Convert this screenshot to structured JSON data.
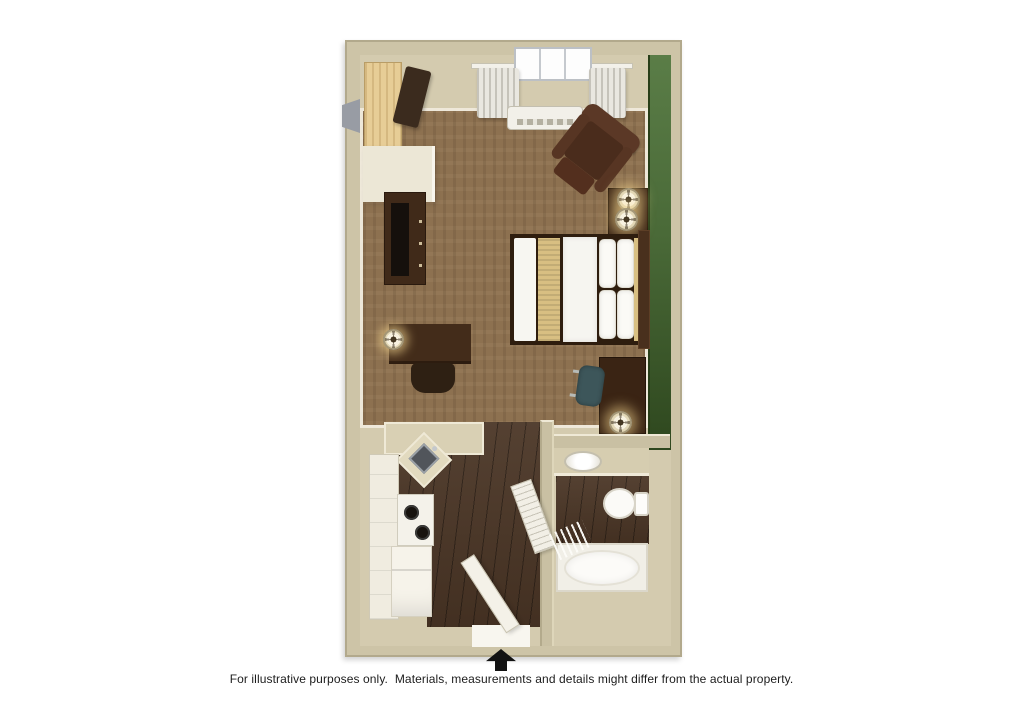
{
  "page": {
    "background_color": "#ffffff"
  },
  "floor_plan": {
    "kind": "studio-suite-3d-floor-plan",
    "colors": {
      "outer_wall": "#cdc4a7",
      "accent_wall_green": "#3f5c2e",
      "carpet_brown": "#8d7150",
      "dark_wood_floor": "#4a3525",
      "dark_furniture": "#3f2a1c",
      "closet_light_wood": "#e7cd96",
      "fixture_white": "#f4f2ec",
      "office_chair_teal": "#3d565a"
    },
    "rooms": {
      "main_room": {
        "floor": "carpet",
        "items": [
          "closet",
          "wardrobe-shelf",
          "tv-dresser",
          "television",
          "desk-with-lamp",
          "desk-chair",
          "window-with-curtains",
          "ptac-air-conditioner",
          "recliner-armchair",
          "nightstand-with-two-lamps",
          "queen-bed",
          "green-accent-wall",
          "work-desk",
          "office-chair",
          "desk-lamp"
        ]
      },
      "kitchen": {
        "floor": "dark-wood",
        "items": [
          "upper-and-lower-cabinets",
          "corner-sink",
          "two-burner-stove",
          "refrigerator",
          "counter"
        ]
      },
      "bathroom": {
        "floor": "dark-wood-and-tile",
        "items": [
          "vanity-sink",
          "toilet",
          "bathtub",
          "shower-curtain",
          "louvered-door"
        ]
      },
      "entry": {
        "floor": "dark-wood",
        "items": [
          "entry-door-open"
        ]
      }
    }
  },
  "compass": {
    "symbol": "north-arrow",
    "direction": "up"
  },
  "disclaimer": {
    "text": "For illustrative purposes only.  Materials, measurements and details might differ from the actual property."
  }
}
